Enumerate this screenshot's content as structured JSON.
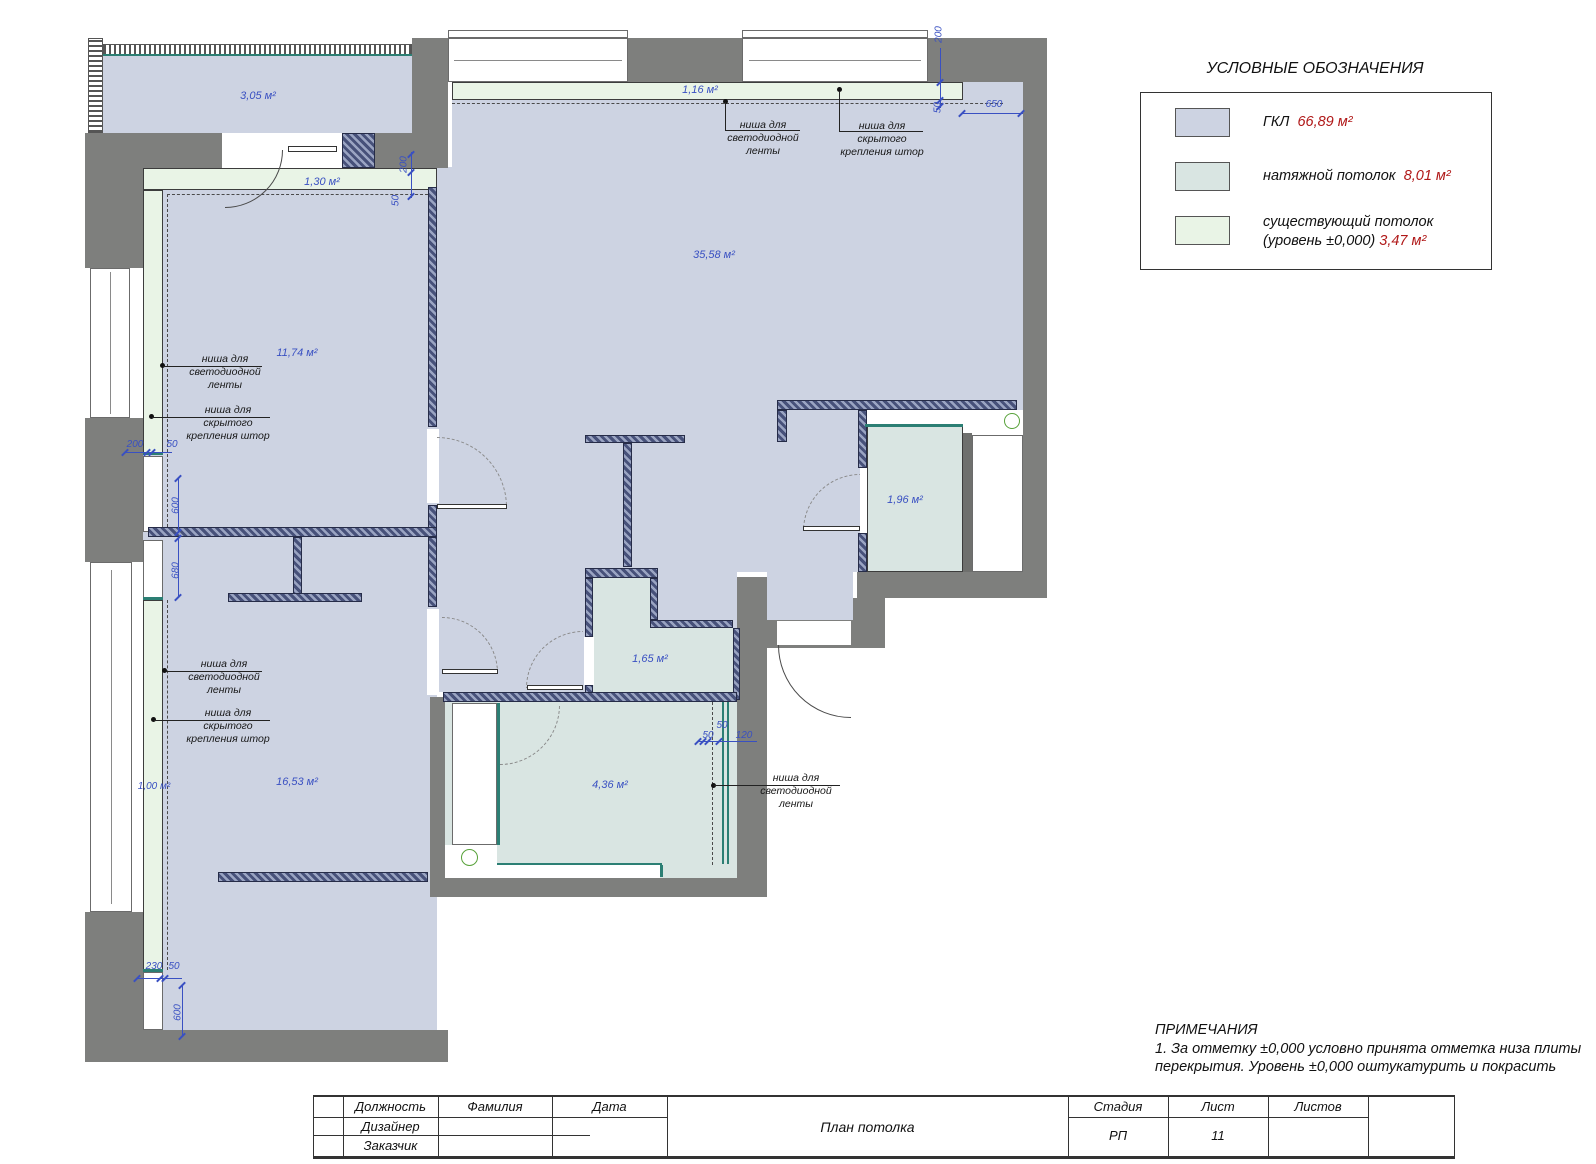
{
  "drawing": {
    "type": "ceiling-plan"
  },
  "legend": {
    "title": "УСЛОВНЫЕ ОБОЗНАЧЕНИЯ",
    "items": [
      {
        "label": "ГКЛ",
        "value": "66,89 м²",
        "color": "#cdd3e2"
      },
      {
        "label": "натяжной потолок",
        "value": "8,01 м²",
        "color": "#d9e5e2"
      },
      {
        "label": "существующий потолок",
        "label2": "(уровень ±0,000)",
        "value": "3,47 м²",
        "color": "#e9f4e6"
      }
    ]
  },
  "notes": {
    "heading": "ПРИМЕЧАНИЯ",
    "line1": "1. За отметку ±0,000 условно принята отметка низа плиты",
    "line2": "перекрытия. Уровень ±0,000 оштукатурить и покрасить"
  },
  "titleblock": {
    "col_position": "Должность",
    "col_surname": "Фамилия",
    "col_date": "Дата",
    "row_designer": "Дизайнер",
    "row_client": "Заказчик",
    "drawing_title": "План потолка",
    "col_stage": "Стадия",
    "col_sheet": "Лист",
    "col_sheets": "Листов",
    "stage": "РП",
    "sheet": "11"
  },
  "rooms": {
    "balcony": "3,05 м²",
    "strip_hall": "1,30 м²",
    "hall": "11,74 м²",
    "strip_living": "1,16 м²",
    "living": "35,58 м²",
    "wardrobe": "1,96 м²",
    "bathroom": "1,65 м²",
    "kitchen": "4,36 м²",
    "bedroom": "16,53 м²",
    "strip_bedroom": "1,00 м²"
  },
  "dims": {
    "d200": "200",
    "d50": "50",
    "d650": "650",
    "d600": "600",
    "d680": "680",
    "d230": "230",
    "d120": "120"
  },
  "annotations": {
    "led1": "ниша для",
    "led2": "светодиодной",
    "led3": "ленты",
    "curtain1": "ниша для скрытого",
    "curtain2": "крепления штор"
  }
}
